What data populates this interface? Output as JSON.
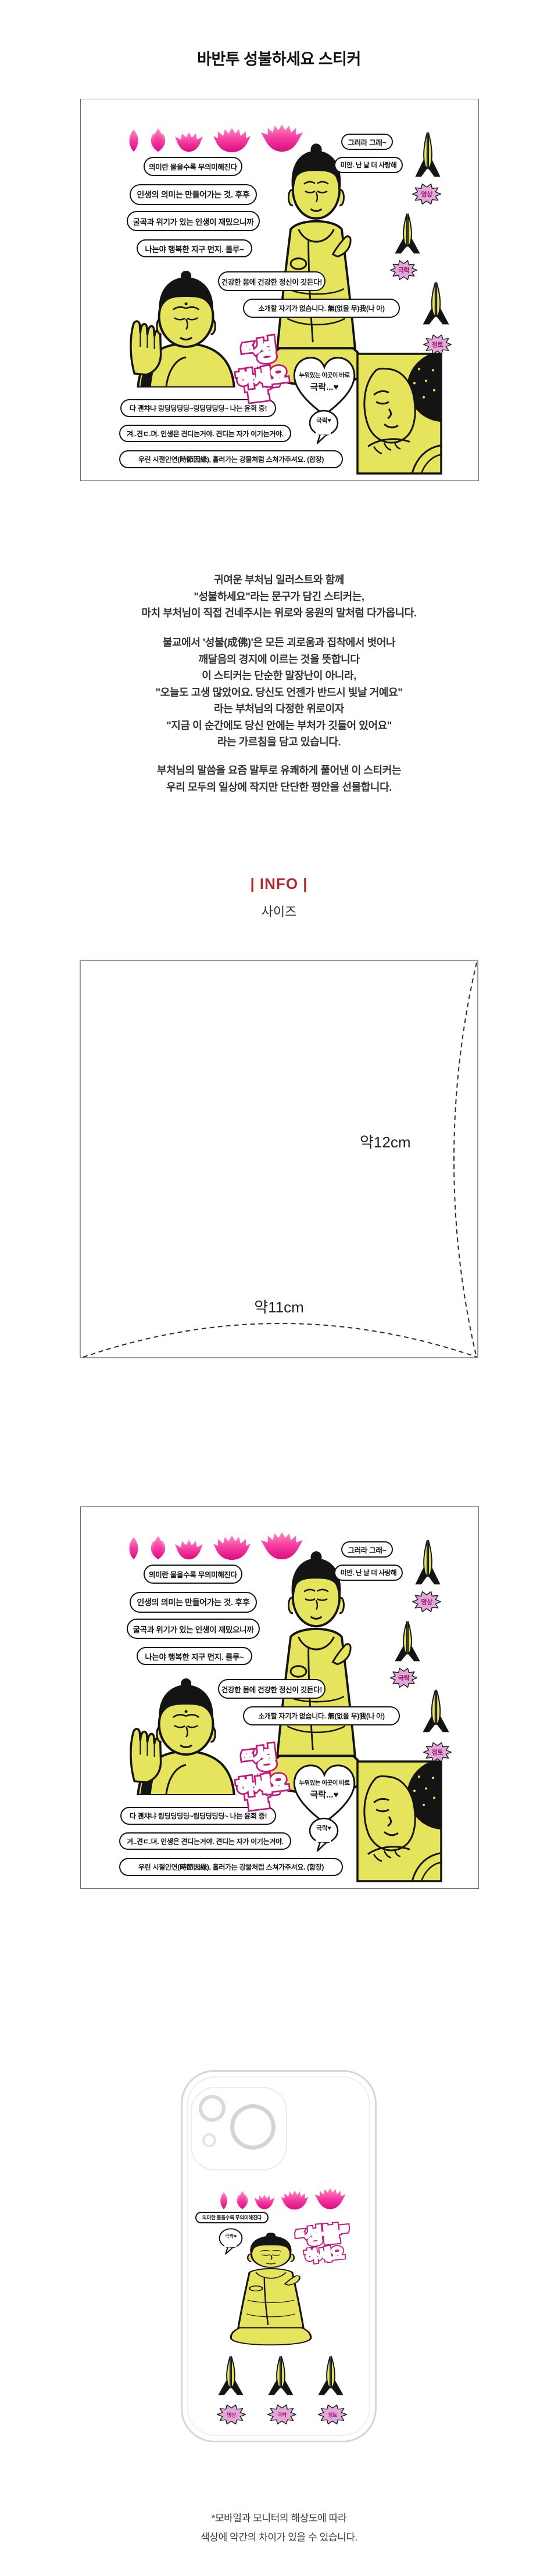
{
  "title": "바반투 성불하세요 스티커",
  "colors": {
    "lotus_pink_light": "#ff8ec4",
    "lotus_pink_deep": "#dd0b84",
    "buddha_yellow": "#e6e45c",
    "outline_black": "#141414",
    "badge_violet": "#e2a8da",
    "logo_pink": "#c2187f",
    "info_red": "#b3282d"
  },
  "icons": {
    "lotus_stages": [
      "lotus-bud",
      "lotus-budding",
      "lotus-half-bloom",
      "lotus-bloom",
      "lotus-full-bloom"
    ],
    "praying_hands": "praying-hands",
    "lotus_badge": "spiky-lotus-badge",
    "heart_sticker": "heart-outline",
    "speech_bubble": "speech-bubble"
  },
  "sheet": {
    "pills": [
      "의미란 물을수록 무의미해진다",
      "인생의 의미는 만들어가는 것. 후후",
      "굴곡과 위기가 있는 인생이 재밌으니까",
      "나는야 행복한 지구 먼지. 룰루~",
      "그러라 그래~",
      "미안. 난 날 더 사랑해",
      "건강한 몸에 건강한 정신이 깃든다!",
      "소개할 자기가 없습니다. 無(없을 무)我(나 아)",
      "다 괜챠냐 링딩딩딩딩~링딩딩딩딩~ 나는 윤회 중!",
      "겨..견ㄷ.뎌. 인생은 견디는거야. 견디는 자가 이기는거야.",
      "우린 시절인연(時節因緣), 흘러가는 강물처럼 스쳐가주셔요. (합장)"
    ],
    "logo_top": "“성불”",
    "logo_bottom": "하세요",
    "heart_line1": "누워있는 이곳이 바로",
    "heart_line2": "극락...♥",
    "bubble": "극락♥",
    "badge_meditation": "명상",
    "badge_paradise": "극락",
    "badge_pureland": "정토"
  },
  "description": {
    "p1": [
      "귀여운 부처님 일러스트와 함께",
      "\"성불하세요\"라는 문구가 담긴 스티커는,",
      "마치 부처님이 직접 건네주시는 위로와 응원의 말처럼 다가옵니다."
    ],
    "p2": [
      "불교에서 '성불(成佛)'은 모든 괴로움과 집착에서 벗어나",
      "깨달음의 경지에 이르는 것을 뜻합니다",
      "이 스티커는 단순한 말장난이 아니라,",
      "\"오늘도 고생 많았어요. 당신도 언젠가 반드시 빛날 거예요\"",
      "라는 부처님의 다정한 위로이자",
      "\"지금 이 순간에도 당신 안에는 부처가 깃들어 있어요\"",
      "라는 가르침을 담고 있습니다."
    ],
    "p3": [
      "부처님의 말씀을 요즘 말투로 유쾌하게 풀어낸 이 스티커는",
      "우리 모두의 일상에 작지만 단단한 평안을 선물합니다."
    ]
  },
  "info": {
    "header": "| INFO |",
    "size_label": "사이즈",
    "height_cm": "약12cm",
    "width_cm": "약11cm"
  },
  "footer": {
    "line1": "*모바일과 모니터의 해상도에 따라",
    "line2": "색상에 약간의 차이가 있을 수 있습니다."
  }
}
